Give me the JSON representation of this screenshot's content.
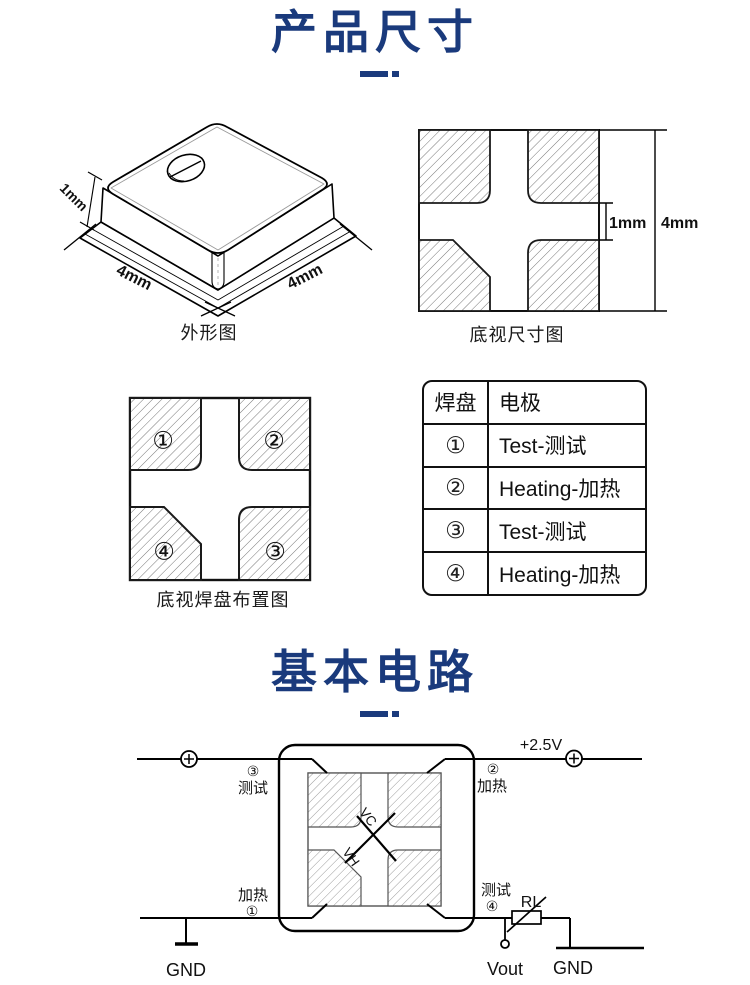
{
  "page": {
    "accent": "#1a3a7c",
    "background": "#ffffff"
  },
  "section1": {
    "title": "产品尺寸"
  },
  "section2": {
    "title": "基本电路"
  },
  "outline_fig": {
    "dim_height": "1mm",
    "dim_left": "4mm",
    "dim_right": "4mm",
    "caption": "外形图"
  },
  "bottom_view_fig": {
    "dim_gap": "1mm",
    "dim_total": "4mm",
    "caption": "底视尺寸图"
  },
  "pad_layout_fig": {
    "pads": [
      "①",
      "②",
      "③",
      "④"
    ],
    "caption": "底视焊盘布置图"
  },
  "pad_table": {
    "headers": [
      "焊盘",
      "电极"
    ],
    "rows": [
      [
        "①",
        "Test-测试"
      ],
      [
        "②",
        "Heating-加热"
      ],
      [
        "③",
        "Test-测试"
      ],
      [
        "④",
        "Heating-加热"
      ]
    ]
  },
  "circuit": {
    "supply_label": "+2.5V",
    "pin_top_left": {
      "num": "③",
      "label": "测试"
    },
    "pin_top_right": {
      "num": "②",
      "label": "加热"
    },
    "pin_bottom_left": {
      "num": "①",
      "label": "加热"
    },
    "pin_bottom_right": {
      "num": "④",
      "label": "测试"
    },
    "ground_left": "GND",
    "ground_right": "GND",
    "output_label": "Vout",
    "load_resistor": "RL",
    "vc_label": "VC",
    "vh_label": "VH"
  }
}
